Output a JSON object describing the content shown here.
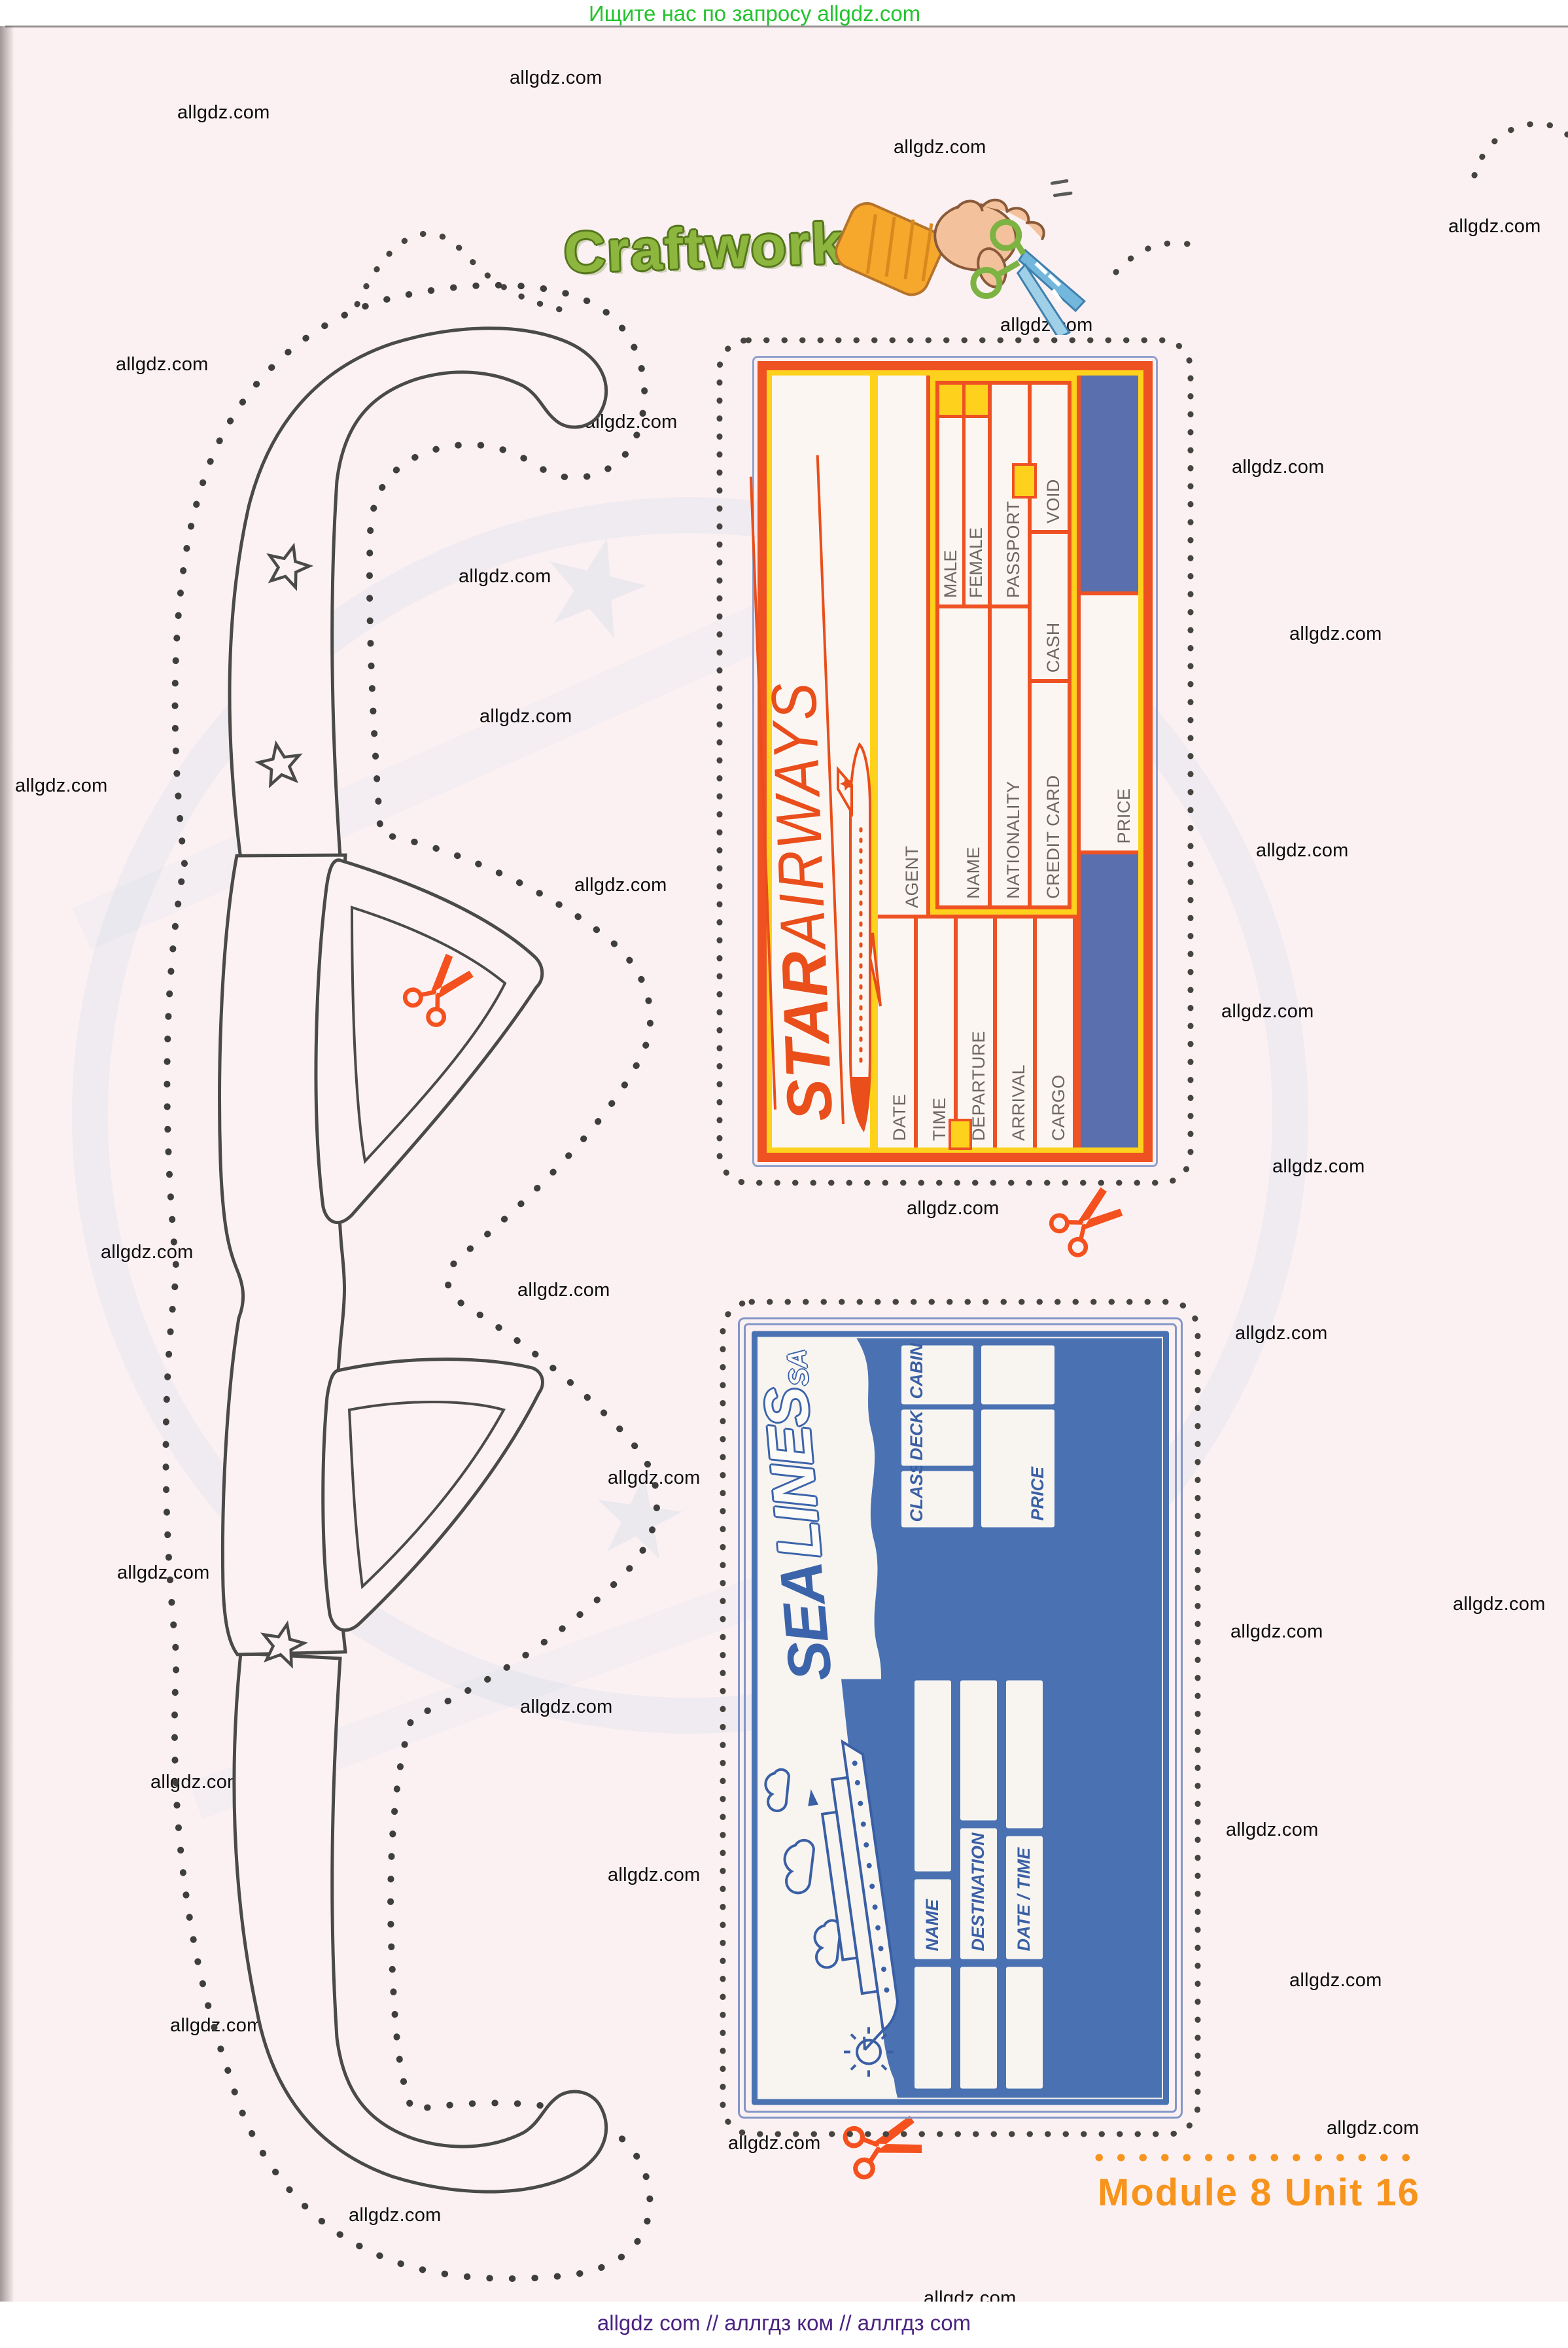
{
  "page": {
    "header": "Ищите нас по запросу allgdz.com",
    "footer": "allgdz com  //  аллгдз ком  //  аллгдз com",
    "module_label": "Module 8 Unit 16"
  },
  "watermark": {
    "text": "allgdz.com"
  },
  "craftwork": {
    "title": "Craftwork"
  },
  "star_ticket": {
    "brand": {
      "word1": "STAR",
      "word2": "AIRWAYS"
    },
    "fields": {
      "agent": "AGENT",
      "name": "NAME",
      "nationality": "NATIONALITY",
      "credit_card": "CREDIT CARD",
      "price": "PRICE",
      "male": "MALE",
      "female": "FEMALE",
      "passport": "PASSPORT",
      "void": "VOID",
      "cash": "CASH",
      "date": "DATE",
      "time": "TIME",
      "departure": "DEPARTURE",
      "arrival": "ARRIVAL",
      "cargo": "CARGO"
    }
  },
  "sea_ticket": {
    "brand": {
      "word1": "SEA",
      "word2": "LINES",
      "suffix": "SA"
    },
    "fields": {
      "cabin": "CABIN",
      "deck": "DECK",
      "class": "CLASS",
      "price": "PRICE",
      "name": "NAME",
      "destination": "DESTINATION",
      "date_time": "DATE / TIME"
    }
  },
  "colors": {
    "header_green": "#23c32e",
    "footer_purple": "#4b2380",
    "module_orange": "#f7941d",
    "star_orange": "#ee5223",
    "star_yellow": "#fed21c",
    "star_blue_block": "#5a6fae",
    "sea_blue": "#4a72b2",
    "watermark_black": "#0c0c0c",
    "cutline_gray": "#45443f"
  },
  "icons": {
    "scissors": "scissors-icon",
    "hand_scissors": "hand-with-scissors-icon",
    "airplane": "airplane-icon",
    "ship": "ship-icon",
    "sun": "sun-icon",
    "cloud": "cloud-icon",
    "star": "star-icon",
    "glasses": "glasses-template"
  }
}
